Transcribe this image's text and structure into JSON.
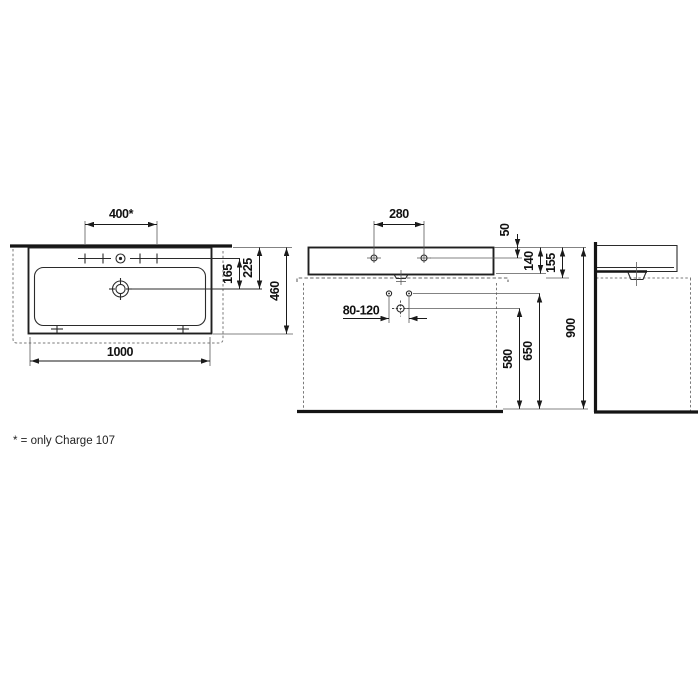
{
  "footnote": "* = only Charge 107",
  "top_view": {
    "tap_hole_spacing": "400*",
    "tap_hole_offset": "165",
    "drain_offset": "225",
    "depth": "460",
    "width": "1000"
  },
  "front_view": {
    "tap_hole_pitch": "280",
    "rim_to_tap_hole": "50",
    "ceramic_height": "140",
    "overall_height": "155",
    "bracket_spacing_range": "80-120",
    "drain_height": "580",
    "bracket_height": "650",
    "rim_height": "900"
  }
}
